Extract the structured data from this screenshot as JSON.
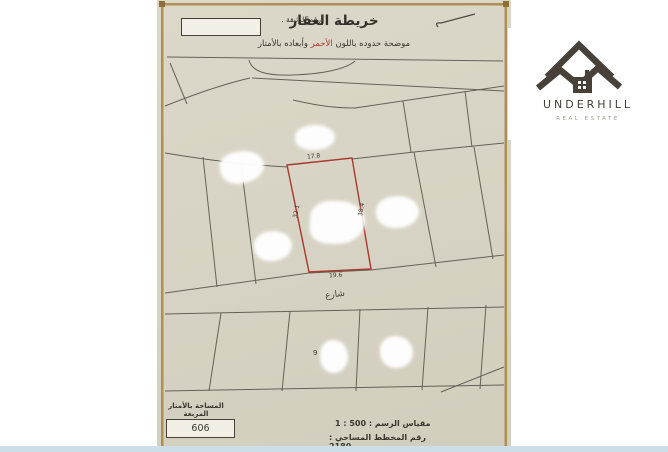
{
  "header": {
    "doc_number_label": "رقم الوثيقة .",
    "title": "خريطة العقار",
    "subtitle_prefix": "موضحة حدوده باللون",
    "subtitle_highlight": "الأحمر",
    "subtitle_suffix": "وأبعاده بالأمتار",
    "highlight_color": "#b5332a"
  },
  "map": {
    "street_label": "شارع",
    "plot_number": "9",
    "highlight_plot": {
      "outline_color": "#a8392d",
      "dim_top": "17.8",
      "dim_left": "32.1",
      "dim_right": "38.4",
      "dim_bottom": "19.6"
    }
  },
  "footer": {
    "area_label": "المساحة بالأمتار المربعة",
    "area_value": "606",
    "scale_text": "مقياس الرسم : 500 : 1",
    "plan_text": "رقم المخطط المساحي : 2180"
  },
  "logo": {
    "name": "UNDERHILL",
    "tagline": "REAL ESTATE",
    "color": "#48413a"
  }
}
